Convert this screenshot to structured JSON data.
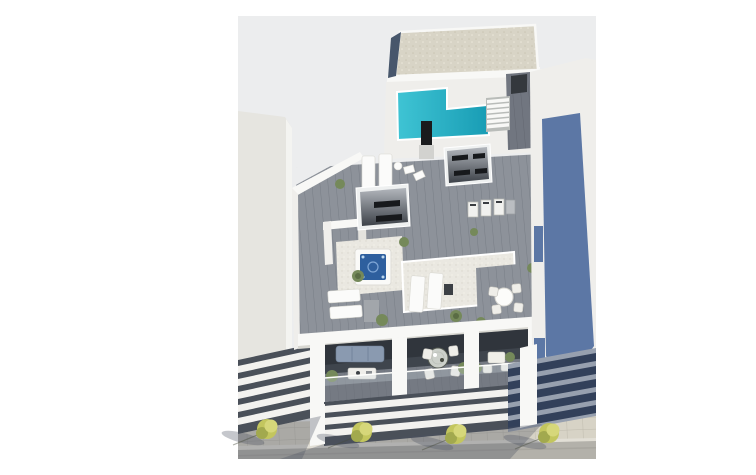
{
  "meta": {
    "description": "3D aerial architectural render of a modern apartment building penthouse level with rooftop pool, jacuzzi, terraces and street below",
    "width": 756,
    "height": 443
  },
  "colors": {
    "page_bg": "#ffffff",
    "render_bg": "#ecedee",
    "white_hi": "#f8f8f6",
    "white_mid": "#efeeeb",
    "neighbor_left": "#e6e5e0",
    "gravel": "#d8d4c6",
    "slate_edge": "#47566b",
    "pool": "#2db6c9",
    "pool_deep": "#1fa0b6",
    "deck": "#8d929a",
    "deck_dark": "#757a83",
    "tile_white": "#eae8e1",
    "dark_vent": "#17191c",
    "hot_tub": "#2e5f9e",
    "stair_wood": "#717680",
    "balcony_shade": "#3f454d",
    "louver_white": "#f3f2ef",
    "louver_gap": "#4a5059",
    "slate_wall": "#5c77a5",
    "slate_slat": "#32405a",
    "slate_band": "#97a0af",
    "sofa": "#8a9ab0",
    "plant": "#75895a",
    "plant_dark": "#5a6c44",
    "tree": "#c3c65e",
    "tree_hi": "#d6d77a",
    "tree_dark": "#a2a94e",
    "sidewalk": "#d7d3c6",
    "curb": "#e2dfd6",
    "road": "#b3b1aa",
    "shadow": "rgba(74,80,96,0.32)"
  },
  "scene": {
    "objects": [
      "gravel-roof",
      "rooftop-pool",
      "pool-shower",
      "exterior-staircase",
      "center-skylight",
      "right-skylight",
      "hot-tub",
      "sun-loungers",
      "rooftop-appliances",
      "dining-terrace-round-table",
      "potted-plants",
      "balcony-sofa",
      "balcony-coffee-table",
      "balcony-dining-set",
      "balcony-bistro-set",
      "facade-louvers",
      "neighbor-building-left",
      "neighbor-building-right-slate-wall",
      "sidewalk-pavers",
      "street-trees-x4",
      "road"
    ]
  }
}
